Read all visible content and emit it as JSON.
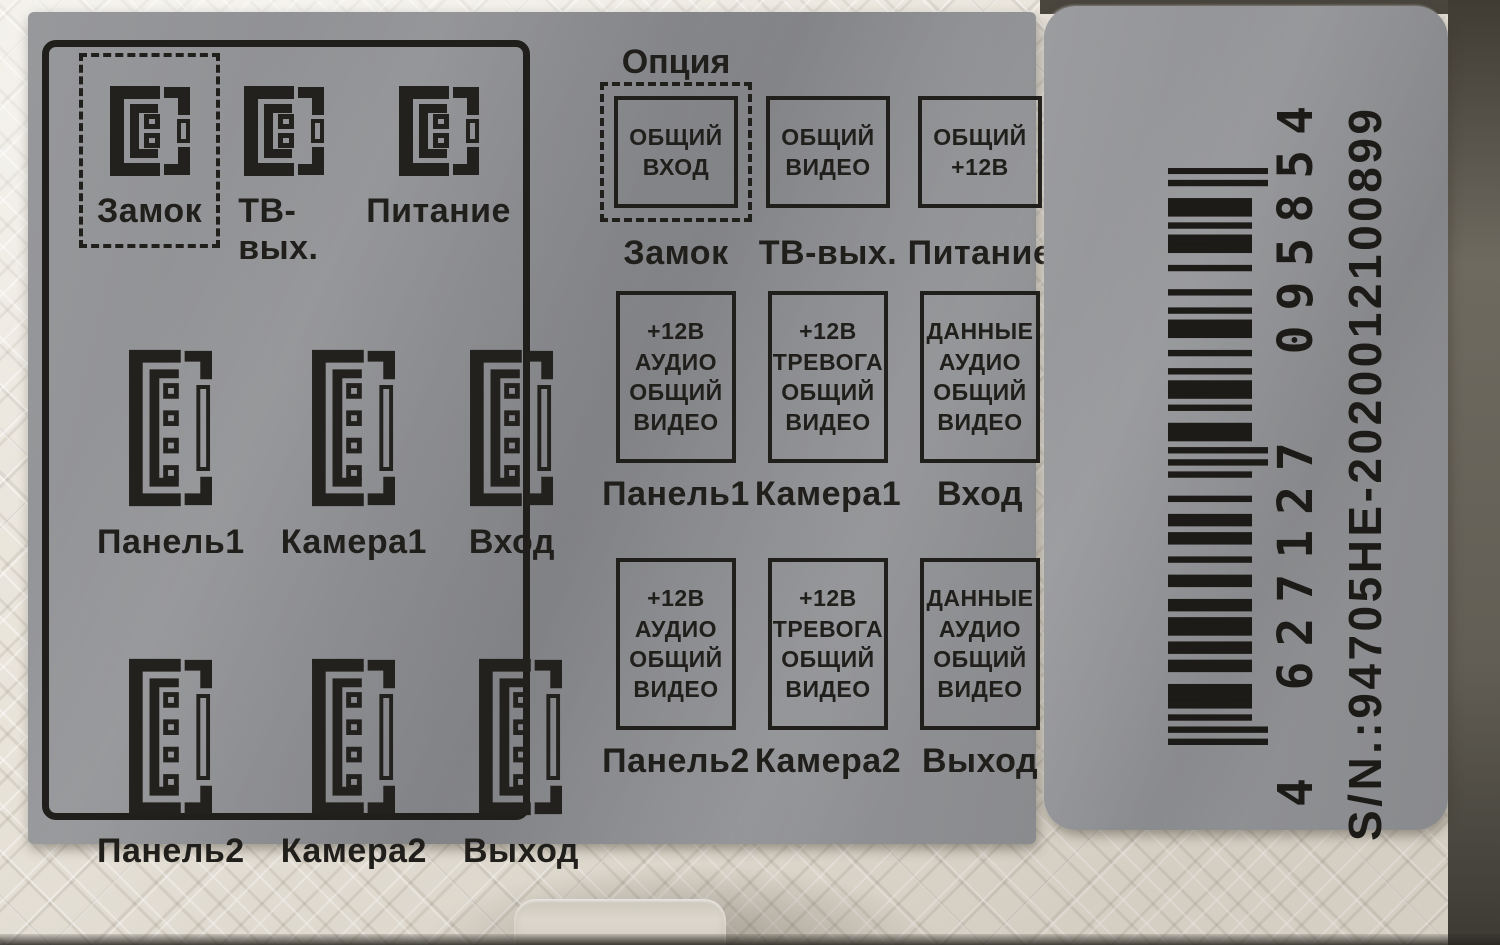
{
  "colors": {
    "sticker_gray": "#8d8e91",
    "print_black": "#211f1b",
    "device_cream": "#e9e4da"
  },
  "left_panel": {
    "rows": [
      {
        "items": [
          {
            "label": "Замок"
          },
          {
            "label": "ТВ-вых."
          },
          {
            "label": "Питание"
          }
        ]
      },
      {
        "items": [
          {
            "label": "Панель1"
          },
          {
            "label": "Камера1"
          },
          {
            "label": "Вход"
          }
        ]
      },
      {
        "items": [
          {
            "label": "Панель2"
          },
          {
            "label": "Камера2"
          },
          {
            "label": "Выход"
          }
        ]
      }
    ]
  },
  "pinout_panel": {
    "header": "Опция",
    "rows": [
      {
        "items": [
          {
            "pins": "ОБЩИЙ\nВХОД",
            "label": "Замок"
          },
          {
            "pins": "ОБЩИЙ\nВИДЕО",
            "label": "ТВ-вых."
          },
          {
            "pins": "ОБЩИЙ\n+12В",
            "label": "Питание"
          }
        ]
      },
      {
        "items": [
          {
            "pins": "+12В\nАУДИО\nОБЩИЙ\nВИДЕО",
            "label": "Панель1"
          },
          {
            "pins": "+12В\nТРЕВОГА\nОБЩИЙ\nВИДЕО",
            "label": "Камера1"
          },
          {
            "pins": "ДАННЫЕ\nАУДИО\nОБЩИЙ\nВИДЕО",
            "label": "Вход"
          }
        ]
      },
      {
        "items": [
          {
            "pins": "+12В\nАУДИО\nОБЩИЙ\nВИДЕО",
            "label": "Панель2"
          },
          {
            "pins": "+12В\nТРЕВОГА\nОБЩИЙ\nВИДЕО",
            "label": "Камера2"
          },
          {
            "pins": "ДАННЫЕ\nАУДИО\nОБЩИЙ\nВИДЕО",
            "label": "Выход"
          }
        ]
      }
    ]
  },
  "barcode_sticker": {
    "ean_groups": [
      "4",
      "627127",
      "095854"
    ],
    "serial": "S/N.:94705HE-2020012100899",
    "modules": "10101011110011011011101100110010011011001000101010111001011101001001110100100010011101011100101"
  }
}
